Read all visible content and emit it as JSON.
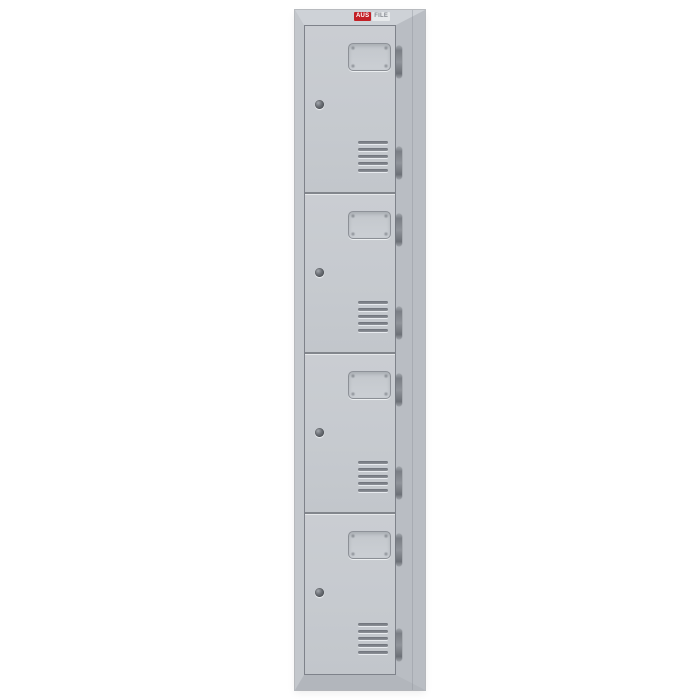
{
  "logo": {
    "primary": "AUS",
    "secondary": "FILE"
  },
  "locker": {
    "description": "tall single-column steel locker, four tiers",
    "door_count": 4,
    "vent_slat_count": 5,
    "hinges_per_door": 2,
    "doors": [
      {
        "id": "1",
        "height": 168
      },
      {
        "id": "2",
        "height": 160
      },
      {
        "id": "3",
        "height": 160
      },
      {
        "id": "4",
        "height": 162
      }
    ],
    "features_per_door": [
      "recessed-handle",
      "cam-lock",
      "ventilation-slats"
    ]
  },
  "colors": {
    "accent": "#c32026",
    "door_face": "#c7cbd0",
    "frame_top": "#ced2d7",
    "frame_left": "#c3c7cc",
    "frame_right": "#b9bdc3",
    "frame_bottom": "#b2b6bc",
    "panel_line": "#82868c",
    "background": "#ffffff"
  }
}
